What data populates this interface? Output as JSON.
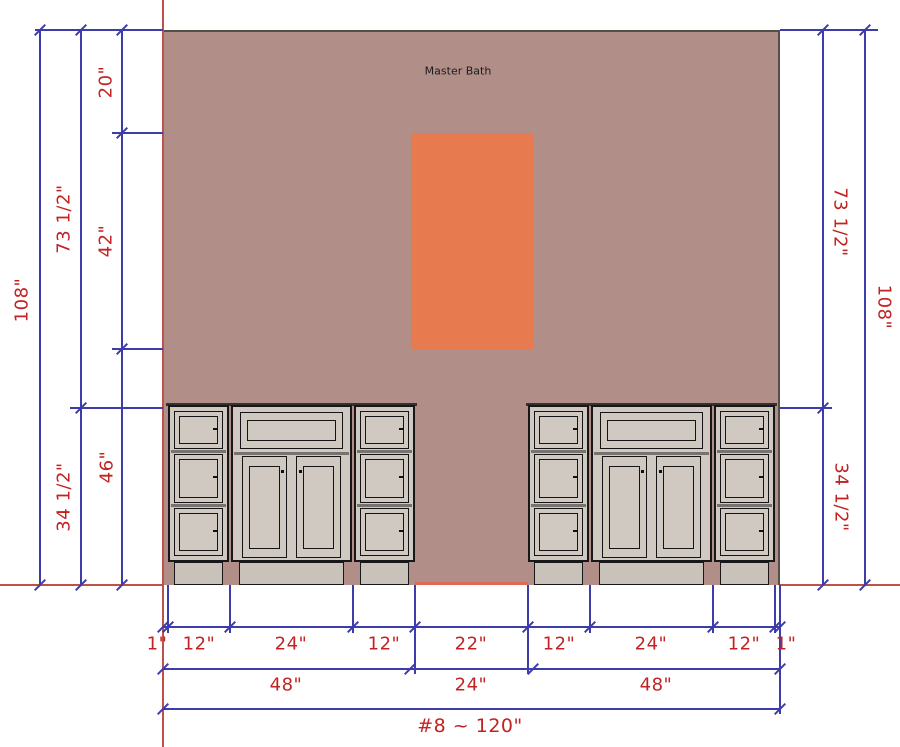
{
  "room": {
    "label": "Master Bath"
  },
  "colors": {
    "wall": "#b18f88",
    "window": "#e87a50",
    "dimension_text": "#c32222",
    "dimension_line": "#3c3caa",
    "construction_line": "#c0504a",
    "cabinet_fill": "#cfc9c2",
    "cabinet_outline": "#17171a"
  },
  "dimensions": {
    "left": {
      "total": "108\"",
      "upper": "73 1/2\"",
      "lower": "34 1/2\"",
      "soffit": "20\"",
      "window_height": "42\"",
      "below_window": "46\""
    },
    "right": {
      "upper": "73 1/2\"",
      "total": "108\"",
      "lower": "34 1/2\""
    },
    "bottom": {
      "row1": [
        "1\"",
        "12\"",
        "24\"",
        "12\"",
        "22\"",
        "12\"",
        "24\"",
        "12\"",
        "1\""
      ],
      "row2": [
        "48\"",
        "24\"",
        "48\""
      ],
      "row3": "#8 ~ 120\""
    }
  }
}
